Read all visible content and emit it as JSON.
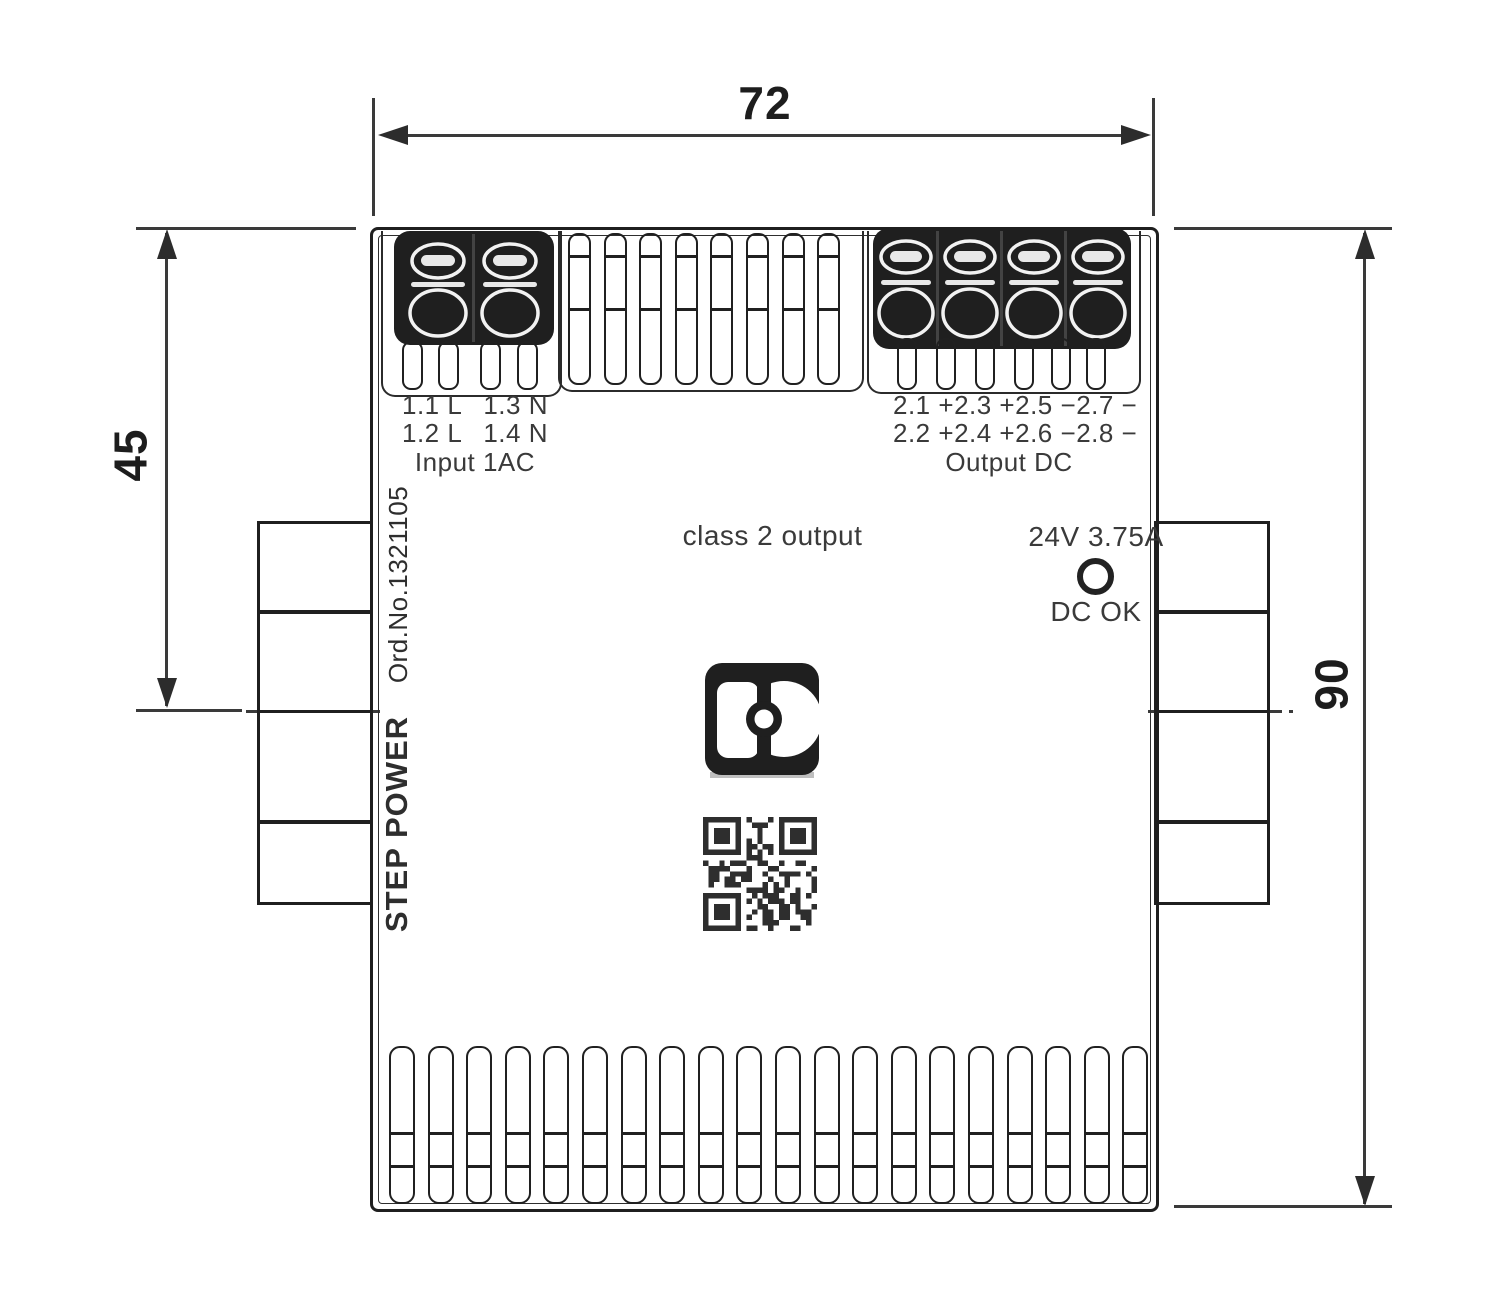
{
  "dimensions": {
    "width": "72",
    "height": "90",
    "upper_height": "45"
  },
  "device": {
    "input": {
      "row1": [
        "1.1 L",
        "1.3 N"
      ],
      "row2": [
        "1.2 L",
        "1.4 N"
      ],
      "caption": "Input 1AC"
    },
    "output": {
      "row1": [
        "2.1 +",
        "2.3 +",
        "2.5 −",
        "2.7 −"
      ],
      "row2": [
        "2.2 +",
        "2.4 +",
        "2.6 −",
        "2.8 −"
      ],
      "caption": "Output DC"
    },
    "class_marking": "class 2 output",
    "rating": "24V 3.75A",
    "led_label": "DC OK",
    "brand_line": "STEP POWER",
    "order_line": "Ord.No.1321105"
  },
  "vents": {
    "top_count": 8,
    "bottom_count": 20
  },
  "colors": {
    "ink": "#1f1f1f",
    "dim_line": "#3a3a3a",
    "label": "#3a3a3a",
    "terminal_fill": "#262626",
    "background": "#ffffff"
  }
}
